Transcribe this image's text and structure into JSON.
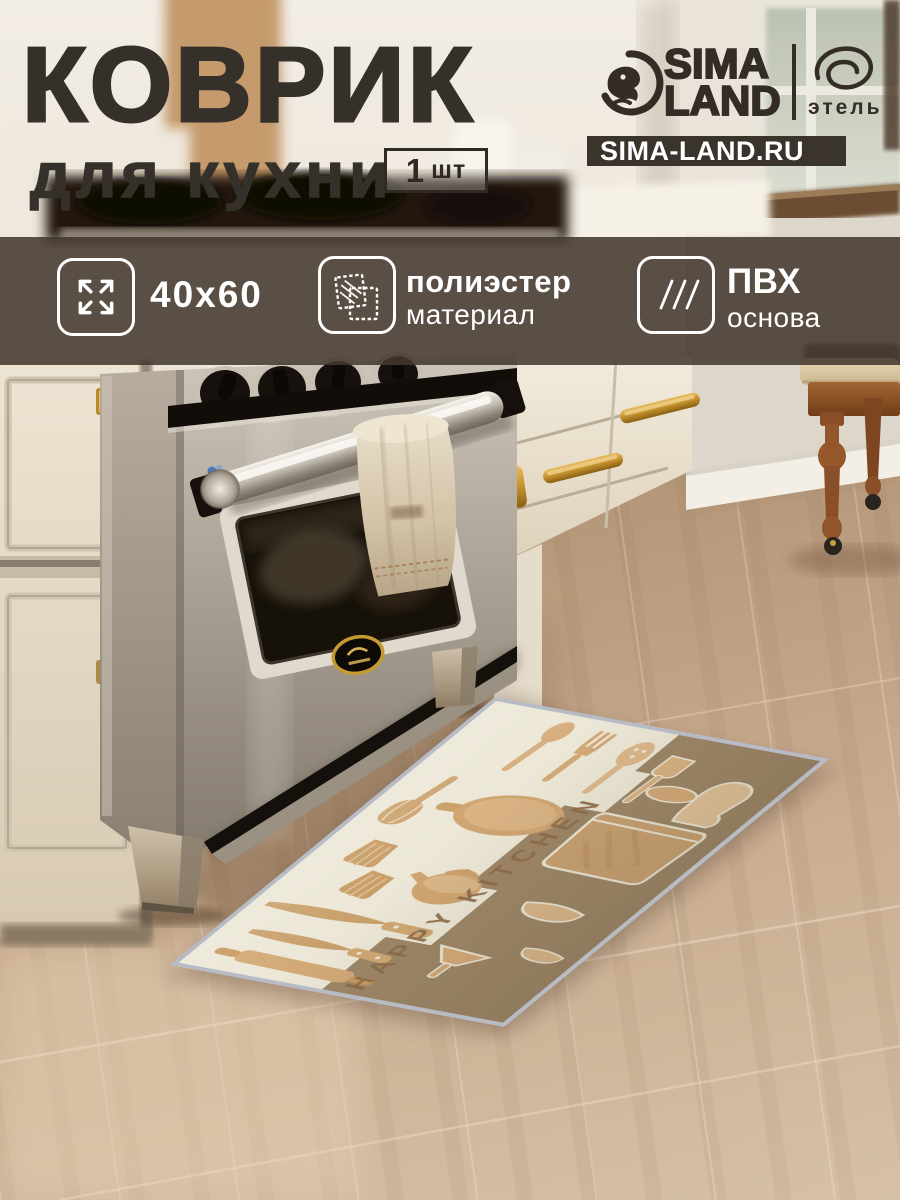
{
  "header": {
    "title_line1": "КОВРИК",
    "title_line2": "для кухни",
    "quantity_value": "1",
    "quantity_unit": "шт"
  },
  "brand": {
    "logo_line1": "SIMA",
    "logo_line2": "LAND",
    "logo_icon": "sima-land-bird-icon",
    "sub_brand": "этель",
    "sub_brand_icon": "etel-script-icon",
    "website": "SIMA-LAND.RU"
  },
  "features": [
    {
      "icon": "expand-arrows-icon",
      "title": "40x60",
      "subtitle": ""
    },
    {
      "icon": "fabric-swatches-icon",
      "title": "полиэстер",
      "subtitle": "материал"
    },
    {
      "icon": "diagonal-hatch-icon",
      "title": "ПВХ",
      "subtitle": "основа"
    }
  ],
  "mat": {
    "print_text": "HAPPY KITCHEN"
  },
  "colors": {
    "title_text": "#35302a",
    "banner_overlay": "rgba(68,56,46,0.87)",
    "banner_text": "#ffffff",
    "site_bar_bg": "#3b342d",
    "floor": "#c3a78c",
    "mat_cream": "#ece7d6",
    "mat_brown": "#9e8768",
    "mat_print_tan": "#d2a977",
    "mat_binding": "#b6bbc6",
    "brass": "#c2912f"
  }
}
